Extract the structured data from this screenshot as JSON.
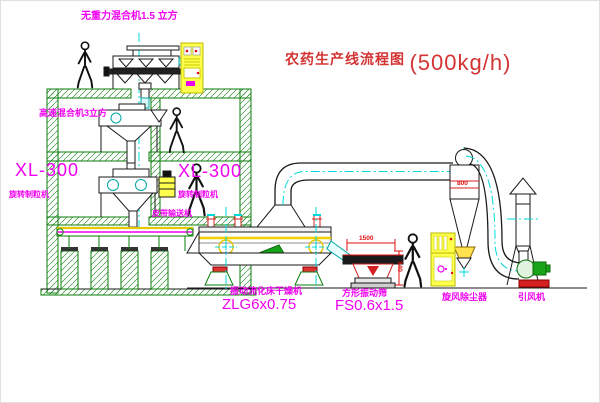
{
  "title": {
    "cn": "农药生产线流程图",
    "capacity": "(500kg/h)"
  },
  "labels": {
    "top_mixer": "无重力混合机1.5 立方",
    "high_speed_mixer": "高速混合机3立方",
    "granulator_left": {
      "model": "XL-300",
      "name": "旋转制粒机"
    },
    "granulator_mid": {
      "model": "XL-300",
      "name": "旋转制粒机"
    },
    "belt_conveyor": "皮带输送机",
    "dryer": {
      "name": "振动流化床干燥机",
      "model": "ZLG6x0.75"
    },
    "screen": {
      "name": "方形振动筛",
      "model": "FS0.6x1.5"
    },
    "cyclone": "旋风除尘器",
    "fan": "引风机"
  },
  "dimensions": {
    "screen_length": "1500",
    "screen_height": "340",
    "cyclone_diameter": "800"
  },
  "colors": {
    "structure_green": "#0b7d0b",
    "centerline_cyan": "#00d9d9",
    "label_magenta": "#f000f0",
    "title_red": "#d43434",
    "dimension_red": "#e01010",
    "cabinet_yellow": "#ffff4d",
    "machine_black": "#1a1a1a"
  }
}
